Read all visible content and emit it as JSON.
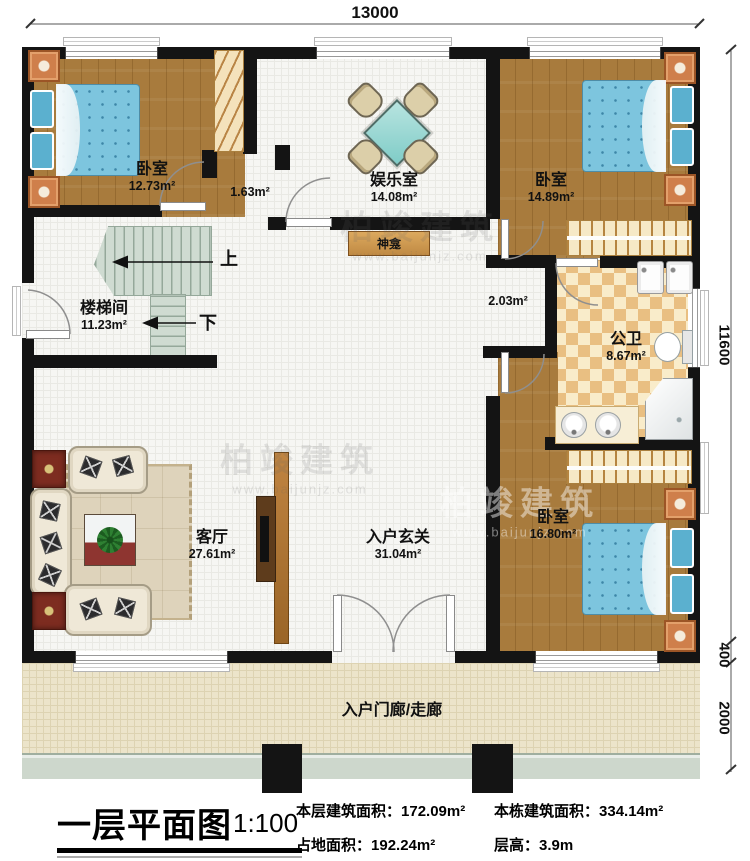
{
  "dimensions": {
    "top_width": "13000",
    "side_height": "11600",
    "sill_depth": "400",
    "porch_depth": "2000"
  },
  "rooms": {
    "bedroom_tl": {
      "name": "卧室",
      "area": "12.73m²"
    },
    "vestibule": {
      "area": "1.63m²"
    },
    "entertainment": {
      "name": "娱乐室",
      "area": "14.08m²"
    },
    "bedroom_tr": {
      "name": "卧室",
      "area": "14.89m²"
    },
    "stairwell": {
      "name": "楼梯间",
      "area": "11.23m²"
    },
    "corridor": {
      "area": "2.03m²"
    },
    "bathroom": {
      "name": "公卫",
      "area": "8.67m²"
    },
    "living_room": {
      "name": "客厅",
      "area": "27.61m²"
    },
    "foyer": {
      "name": "入户玄关",
      "area": "31.04m²"
    },
    "bedroom_br": {
      "name": "卧室",
      "area": "16.80m²"
    },
    "porch": {
      "name": "入户门廊/走廊"
    }
  },
  "features": {
    "shrine": "神龛",
    "stair_up": "上",
    "stair_down": "下"
  },
  "watermark": {
    "brand": "柏竣建筑",
    "url": "www.baijunjz.com"
  },
  "titleblock": {
    "title": "一层平面图",
    "scale": "1:100",
    "stats": [
      {
        "label": "本层建筑面积：",
        "value": "172.09m²"
      },
      {
        "label": "本栋建筑面积：",
        "value": "334.14m²"
      },
      {
        "label": "占地面积：",
        "value": "192.24m²"
      },
      {
        "label": "层高：",
        "value": "3.9m"
      }
    ]
  }
}
